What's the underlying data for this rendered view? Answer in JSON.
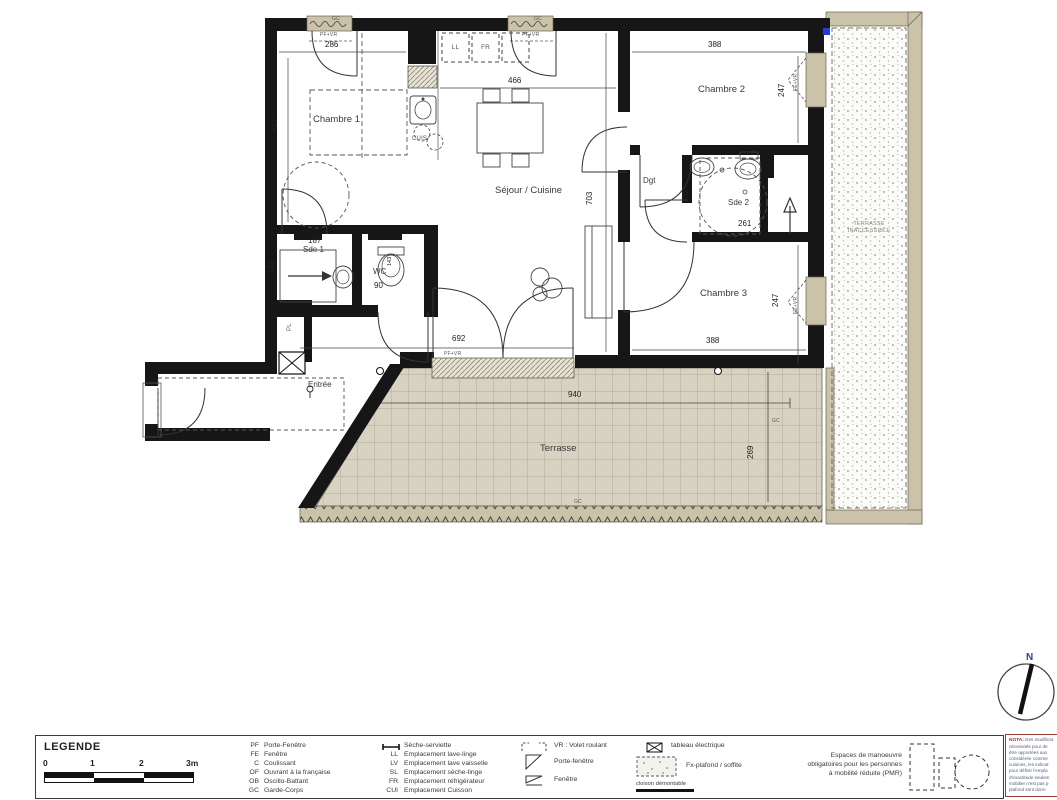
{
  "plan": {
    "rooms": {
      "chambre1": "Chambre 1",
      "chambre2": "Chambre 2",
      "chambre3": "Chambre 3",
      "sejour": "Séjour / Cuisine",
      "dgt": "Dgt",
      "sde1": "Sde 1",
      "sde2": "Sde 2",
      "wc": "WC",
      "entree": "Entrée",
      "terrasse": "Terrasse",
      "terrasse_inaccessible_1": "TERRASSE",
      "terrasse_inaccessible_2": "INACCESSIBLE",
      "placard": "PL",
      "cuisson": "CUIS",
      "lave_linge": "LL",
      "refrigerateur": "FR"
    },
    "dims": {
      "chambre1_w": "286",
      "chambre1_h": "414",
      "sejour_w": "466",
      "sejour_h": "703",
      "chambre2_w": "388",
      "chambre2_h": "247",
      "sde2_w": "261",
      "sde2_h": "189",
      "sde1_w": "187",
      "sde1_h": "161",
      "wc_w": "90",
      "wc_h": "143",
      "bay_w": "692",
      "chambre3_w": "388",
      "chambre3_h": "247",
      "terrasse_w": "940",
      "terrasse_h": "269"
    },
    "windows": {
      "pf_vr": "PF+VR",
      "fe_vr": "FE+VR",
      "gc": "GC"
    }
  },
  "compass": {
    "north": "N"
  },
  "legend": {
    "title": "LEGENDE",
    "scale_ticks": [
      "0",
      "1",
      "2",
      "3m"
    ],
    "abbreviations": [
      {
        "abbr": "PF",
        "label": "Porte-Fenêtre"
      },
      {
        "abbr": "FE",
        "label": "Fenêtre"
      },
      {
        "abbr": "C",
        "label": "Coulissant"
      },
      {
        "abbr": "OF",
        "label": "Ouvrant à la française"
      },
      {
        "abbr": "OB",
        "label": "Oscillo-Battant"
      },
      {
        "abbr": "GC",
        "label": "Garde-Corps"
      }
    ],
    "emplacements": [
      {
        "abbr": "",
        "label": "Sèche-serviette"
      },
      {
        "abbr": "LL",
        "label": "Emplacement lave-linge"
      },
      {
        "abbr": "LV",
        "label": "Emplacement lave vaisselle"
      },
      {
        "abbr": "SL",
        "label": "Emplacement sèche-linge"
      },
      {
        "abbr": "FR",
        "label": "Emplacement réfrigérateur"
      },
      {
        "abbr": "CUI",
        "label": "Emplacement Cuisson"
      }
    ],
    "symbols": [
      "VR : Volet roulant",
      "Porte-fenêtre",
      "Fenêtre"
    ],
    "symbols2": [
      "tableau électrique",
      "Fx-plafond / soffite",
      "cloison démontable"
    ],
    "pmr_line1": "Espaces de manoeuvre",
    "pmr_line2": "obligatoires pour les personnes",
    "pmr_line3": "à mobilité réduite (PMR)"
  },
  "nota": {
    "title": "NOTA:",
    "lines": [
      "Des modificat",
      "nécessités pour de",
      "être apportées aux",
      "considérée comme",
      "cuisines, les indicat",
      "pour définir l'empla",
      "d'exactitude seulem",
      "mobilier n'est pas p",
      "plafond sont donn"
    ]
  }
}
